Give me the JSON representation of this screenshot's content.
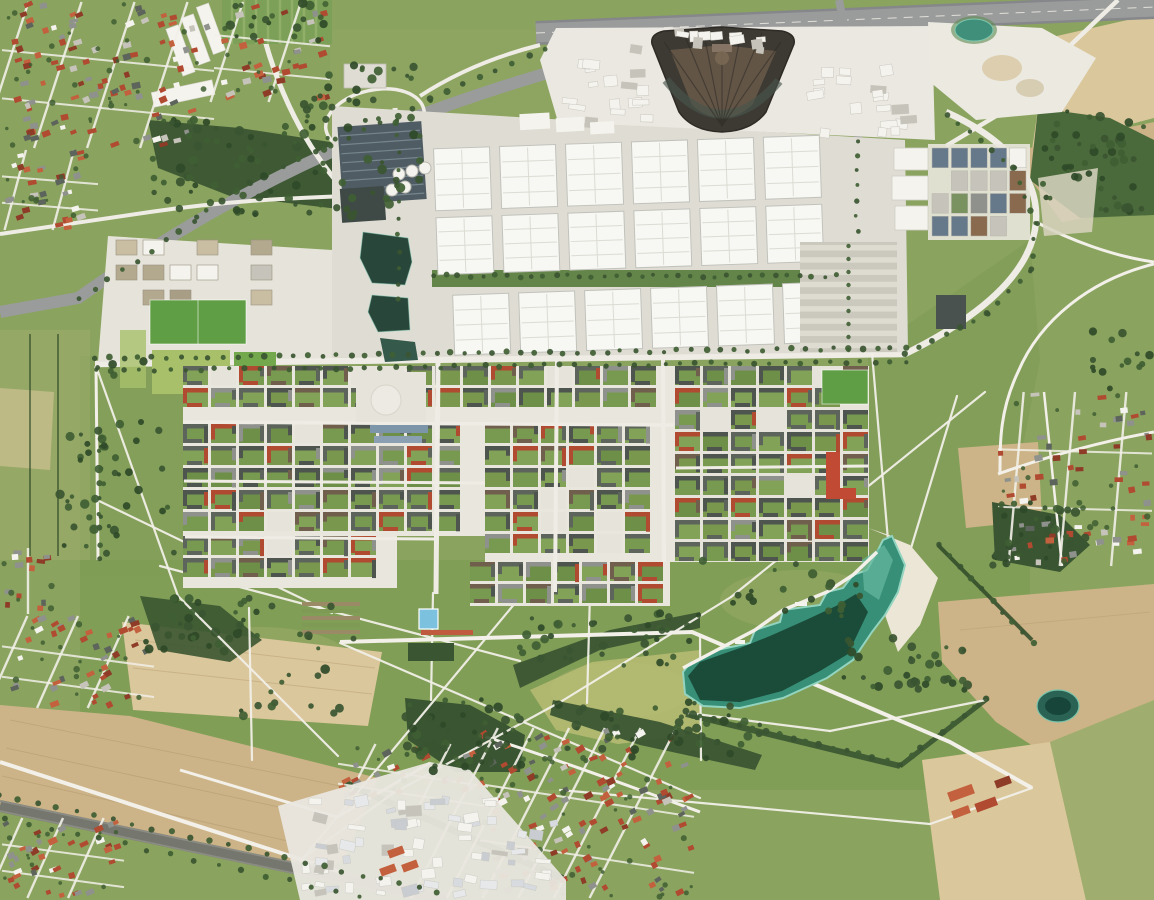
{
  "meta": {
    "title": "Aerial orthophoto of a trade-fair and residential district with park lake, farmland and motorway",
    "width": 1154,
    "height": 900,
    "kind": "aerial-orthophoto",
    "visible_text": "none"
  },
  "regions": [
    {
      "id": "suburb-top-left",
      "label": "suburban village with red and grey tiled roofs"
    },
    {
      "id": "motorway",
      "label": "multi-lane motorway along top edge with loop-ramp interchange"
    },
    {
      "id": "fan-building",
      "label": "large dark fan-shaped hall complex on white apron"
    },
    {
      "id": "exhibition-halls",
      "label": "three rows of white exhibition halls with central green axis"
    },
    {
      "id": "messe-ponds",
      "label": "chain of dark landscaped ponds west of the halls"
    },
    {
      "id": "residential-district",
      "label": "dense perimeter-block housing with green courtyards"
    },
    {
      "id": "riemer-park",
      "label": "large landscaped park crossed by white diagonal paths"
    },
    {
      "id": "lake",
      "label": "turquoise recreation lake with white sand beach on northeast shore"
    },
    {
      "id": "farmland",
      "label": "tan cultivated fields in the corners"
    },
    {
      "id": "railway",
      "label": "railway line crossing the bottom-left corner"
    },
    {
      "id": "suburb-bottom",
      "label": "suburban housing grid at bottom centre"
    },
    {
      "id": "village-right",
      "label": "village with red roofs at right edge"
    },
    {
      "id": "quarry",
      "label": "white gravel works at top right"
    },
    {
      "id": "small-pond",
      "label": "small dark pond at bottom right"
    }
  ],
  "palette": {
    "grass_base": "#8aa35f",
    "park_green": "#7d9b54",
    "park_light": "#97ab69",
    "meadow_pale": "#a9b274",
    "field_tan": "#cdb488",
    "field_tan_light": "#dbc79c",
    "field_tan_dark": "#b39a6e",
    "field_yellow": "#b9bc74",
    "field_green_pale": "#9fae6e",
    "woods_dark": "#3a5531",
    "woods_mid": "#4a6a3c",
    "tree_green": "#3f5e33",
    "hedge_green": "#2f4a28",
    "road_gray": "#9a9c9c",
    "road_dark": "#85878a",
    "road_white": "#eeece4",
    "path_white": "#f2f0e8",
    "concrete": "#dfddd3",
    "apron_white": "#eae8e0",
    "hall_white": "#f7f7f3",
    "hall_line": "#dcdcd4",
    "hall_border": "#c2c2bc",
    "green_axis": "#64854a",
    "pond_dark": "#28463a",
    "pond_mid": "#35594a",
    "glass_dark": "#4f5c63",
    "glass_stripe": "#7b8a92",
    "fan_dark": "#3d3933",
    "fan_mid": "#665948",
    "fan_rim": "#2e2b26",
    "lake_rim": "#92d4bf",
    "lake_mid": "#368f76",
    "lake_dark": "#16402f",
    "lake_light": "#66b89f",
    "beach_sand": "#ece6d6",
    "pool_blue": "#7cc2de",
    "track_red": "#c05a3e",
    "roof_red": "#b04a30",
    "roof_red2": "#c3603d",
    "roof_darkred": "#8e3b28",
    "roof_gray": "#8f918c",
    "roof_light": "#c6c3ba",
    "roof_dark": "#4e554e",
    "roof_dark2": "#5d645c",
    "roof_brown": "#6f5f4c",
    "courtyard": "#789a50",
    "street_light": "#e9e7dd",
    "rail_gray": "#75766e",
    "quarry_white": "#ebe9e0",
    "pitch_green": "#5f9e44",
    "pitch_pale": "#a8c06a",
    "plaza_light": "#e6e4da",
    "estate_blue": "#66798a",
    "estate_green": "#7a9160",
    "estate_brown": "#8a6a4f",
    "pond_teal": "#2a6353",
    "beige_block": "#c9bda2",
    "white_bldg": "#f4f3ee",
    "scrub_pale": "#d8d4c0",
    "allot_green": "#7ca057"
  },
  "generators": {
    "halls": {
      "w": 56,
      "cols": [
        437,
        503,
        569,
        635,
        701,
        767
      ],
      "rows": [
        {
          "y": 142,
          "h": 62,
          "dx": 0
        },
        {
          "y": 211,
          "h": 57,
          "dx": 0
        },
        {
          "y": 289,
          "h": 60,
          "dx": 14
        }
      ]
    },
    "mosaic": {
      "cell_w": 25,
      "cell_h": 19,
      "gap": 3,
      "zones": [
        {
          "x": 183,
          "y": 366,
          "w": 492,
          "h": 58,
          "seed": 11,
          "base": "street_light"
        },
        {
          "x": 183,
          "y": 424,
          "w": 302,
          "h": 112,
          "seed": 22,
          "base": "street_light"
        },
        {
          "x": 183,
          "y": 536,
          "w": 214,
          "h": 52,
          "seed": 33,
          "base": "street_light"
        },
        {
          "x": 485,
          "y": 424,
          "w": 190,
          "h": 138,
          "seed": 44,
          "base": "street_light"
        },
        {
          "x": 675,
          "y": 366,
          "w": 194,
          "h": 196,
          "seed": 55,
          "base": "plaza_light"
        },
        {
          "x": 470,
          "y": 562,
          "w": 200,
          "h": 44,
          "seed": 66,
          "base": "street_light"
        }
      ],
      "roof_colors": [
        "roof_dark",
        "roof_dark2",
        "roof_dark",
        "roof_gray",
        "roof_brown",
        "roof_dark2",
        "roof_red"
      ],
      "yard_colors": [
        "courtyard",
        "#82a258",
        "#6d8f47",
        "#79974d"
      ]
    },
    "suburbs": {
      "roofs": [
        "roof_red",
        "roof_red2",
        "roof_darkred",
        "roof_gray",
        "roof_light",
        "roof_red",
        "roof_dark2",
        "roof_red2",
        "white_bldg",
        "roof_gray",
        "roof_red"
      ],
      "zones": [
        {
          "x": 2,
          "y": 2,
          "w": 212,
          "h": 146,
          "count": 95,
          "angle": -18,
          "seed": 1,
          "streets": 4
        },
        {
          "x": 214,
          "y": 2,
          "w": 116,
          "h": 100,
          "count": 32,
          "angle": -18,
          "seed": 2,
          "streets": 2
        },
        {
          "x": 2,
          "y": 150,
          "w": 96,
          "h": 80,
          "count": 28,
          "angle": -15,
          "seed": 3,
          "streets": 2
        },
        {
          "x": 2,
          "y": 616,
          "w": 152,
          "h": 92,
          "count": 40,
          "angle": -24,
          "seed": 4,
          "streets": 3
        },
        {
          "x": 2,
          "y": 818,
          "w": 122,
          "h": 80,
          "count": 36,
          "angle": -24,
          "seed": 5,
          "streets": 3
        },
        {
          "x": 2,
          "y": 548,
          "w": 52,
          "h": 66,
          "count": 13,
          "angle": 0,
          "seed": 6,
          "streets": 1
        },
        {
          "x": 480,
          "y": 728,
          "w": 214,
          "h": 170,
          "count": 120,
          "angle": -27,
          "seed": 7,
          "streets": 6
        },
        {
          "x": 338,
          "y": 744,
          "w": 150,
          "h": 60,
          "count": 26,
          "angle": -27,
          "seed": 9,
          "streets": 2
        },
        {
          "x": 998,
          "y": 392,
          "w": 154,
          "h": 174,
          "count": 62,
          "angle": -5,
          "seed": 8,
          "streets": 3
        }
      ]
    },
    "industrial_yard": {
      "x": 300,
      "y": 792,
      "w": 262,
      "h": 106,
      "count": 70,
      "seed": 77,
      "colors": [
        "white_bldg",
        "roof_light",
        "#d7dade",
        "#c9cdd2",
        "white_bldg",
        "#e6e8ea"
      ]
    },
    "estate": {
      "x": 932,
      "y": 148,
      "w": 94,
      "h": 88,
      "cols": 5,
      "rows": 4,
      "seed": 88,
      "colors": [
        "estate_blue",
        "estate_green",
        "estate_brown",
        "roof_light",
        "white_bldg",
        "roof_gray",
        "estate_blue",
        "roof_red2"
      ]
    },
    "beige_blocks": {
      "x": 116,
      "y": 240,
      "cols": 6,
      "rows": 3,
      "cw": 21,
      "chh": 15,
      "gap": 6,
      "seed": 99,
      "colors": [
        "beige_block",
        "#b3a98f",
        "roof_light",
        "white_bldg",
        "#a89e86"
      ]
    },
    "white_units": [
      {
        "x": 558,
        "y": 58,
        "w": 100,
        "h": 72,
        "count": 16,
        "seed": 101
      },
      {
        "x": 800,
        "y": 52,
        "w": 125,
        "h": 88,
        "count": 20,
        "seed": 102
      },
      {
        "x": 612,
        "y": 28,
        "w": 160,
        "h": 26,
        "count": 12,
        "seed": 103
      }
    ],
    "parking": {
      "x": 800,
      "y": 242,
      "w": 97,
      "h": 110,
      "rows": 9
    },
    "park_paths": [
      [
        96,
        366,
        178,
        596
      ],
      [
        178,
        596,
        338,
        756
      ],
      [
        160,
        566,
        520,
        661
      ],
      [
        303,
        858,
        516,
        602
      ],
      [
        340,
        643,
        700,
        798
      ],
      [
        985,
        392,
        731,
        597
      ],
      [
        731,
        597,
        562,
        701
      ],
      [
        562,
        701,
        392,
        794
      ],
      [
        97,
        500,
        332,
        613
      ],
      [
        249,
        608,
        252,
        760
      ],
      [
        433,
        593,
        431,
        700
      ],
      [
        590,
        593,
        587,
        703
      ],
      [
        872,
        353,
        888,
        540
      ],
      [
        957,
        396,
        908,
        558
      ],
      [
        700,
        636,
        701,
        760
      ],
      [
        560,
        790,
        930,
        824
      ],
      [
        688,
        713,
        830,
        731
      ],
      [
        830,
        731,
        986,
        700
      ],
      [
        930,
        824,
        1032,
        788
      ],
      [
        392,
        794,
        303,
        858
      ]
    ],
    "tree_rows": [
      {
        "pts": [
          [
            95,
            358
          ],
          [
            905,
            348
          ]
        ],
        "step": 14,
        "r": 2.6
      },
      {
        "pts": [
          [
            95,
            371
          ],
          [
            905,
            361
          ]
        ],
        "step": 15,
        "r": 2.4
      },
      {
        "pts": [
          [
            905,
            354
          ],
          [
            988,
            314
          ],
          [
            1030,
            270
          ],
          [
            1036,
            224
          ],
          [
            1014,
            168
          ],
          [
            948,
            114
          ]
        ],
        "step": 14,
        "r": 2.6
      },
      {
        "pts": [
          [
            80,
            300
          ],
          [
            250,
            182
          ],
          [
            430,
            100
          ],
          [
            545,
            48
          ]
        ],
        "step": 17,
        "r": 2.8
      },
      {
        "pts": [
          [
            0,
            794
          ],
          [
            438,
            892
          ]
        ],
        "step": 19,
        "r": 2.6
      },
      {
        "pts": [
          [
            6,
            818
          ],
          [
            430,
            912
          ]
        ],
        "step": 23,
        "r": 2.4
      },
      {
        "pts": [
          [
            434,
            276
          ],
          [
            836,
            276
          ]
        ],
        "step": 12,
        "r": 2.3
      },
      {
        "pts": [
          [
            857,
            140
          ],
          [
            857,
            230
          ]
        ],
        "step": 13,
        "r": 2.2
      },
      {
        "pts": [
          [
            940,
            546
          ],
          [
            1034,
            644
          ]
        ],
        "step": 15,
        "r": 2.6
      },
      {
        "pts": [
          [
            398,
            120
          ],
          [
            399,
            300
          ]
        ],
        "step": 16,
        "r": 2.2
      },
      {
        "pts": [
          [
            100,
            436
          ],
          [
            100,
            560
          ]
        ],
        "step": 15,
        "r": 2.4
      },
      {
        "pts": [
          [
            686,
            712
          ],
          [
            900,
            764
          ]
        ],
        "step": 13,
        "r": 2.8
      },
      {
        "pts": [
          [
            900,
            764
          ],
          [
            986,
            700
          ]
        ],
        "step": 13,
        "r": 2.6
      }
    ],
    "tree_clumps": [
      {
        "x": 150,
        "y": 118,
        "w": 270,
        "h": 100,
        "n": 85,
        "seed": 12
      },
      {
        "x": 300,
        "y": 64,
        "w": 120,
        "h": 60,
        "n": 28,
        "seed": 13
      },
      {
        "x": 1040,
        "y": 110,
        "w": 112,
        "h": 102,
        "n": 48,
        "seed": 14
      },
      {
        "x": 992,
        "y": 502,
        "w": 96,
        "h": 64,
        "n": 34,
        "seed": 15
      },
      {
        "x": 406,
        "y": 698,
        "w": 118,
        "h": 74,
        "n": 52,
        "seed": 16
      },
      {
        "x": 513,
        "y": 612,
        "w": 190,
        "h": 58,
        "n": 40,
        "seed": 24
      },
      {
        "x": 550,
        "y": 700,
        "w": 212,
        "h": 60,
        "n": 48,
        "seed": 17
      },
      {
        "x": 140,
        "y": 594,
        "w": 120,
        "h": 64,
        "n": 34,
        "seed": 18
      },
      {
        "x": 832,
        "y": 638,
        "w": 150,
        "h": 52,
        "n": 34,
        "seed": 19
      },
      {
        "x": 60,
        "y": 428,
        "w": 56,
        "h": 130,
        "n": 26,
        "seed": 21
      },
      {
        "x": 240,
        "y": 600,
        "w": 120,
        "h": 120,
        "n": 22,
        "seed": 25
      },
      {
        "x": 700,
        "y": 560,
        "w": 160,
        "h": 60,
        "n": 20,
        "seed": 26
      },
      {
        "x": 80,
        "y": 360,
        "w": 100,
        "h": 200,
        "n": 22,
        "seed": 27
      },
      {
        "x": 224,
        "y": 2,
        "w": 106,
        "h": 40,
        "n": 18,
        "seed": 31
      },
      {
        "x": 1090,
        "y": 330,
        "w": 60,
        "h": 60,
        "n": 14,
        "seed": 29
      }
    ]
  }
}
